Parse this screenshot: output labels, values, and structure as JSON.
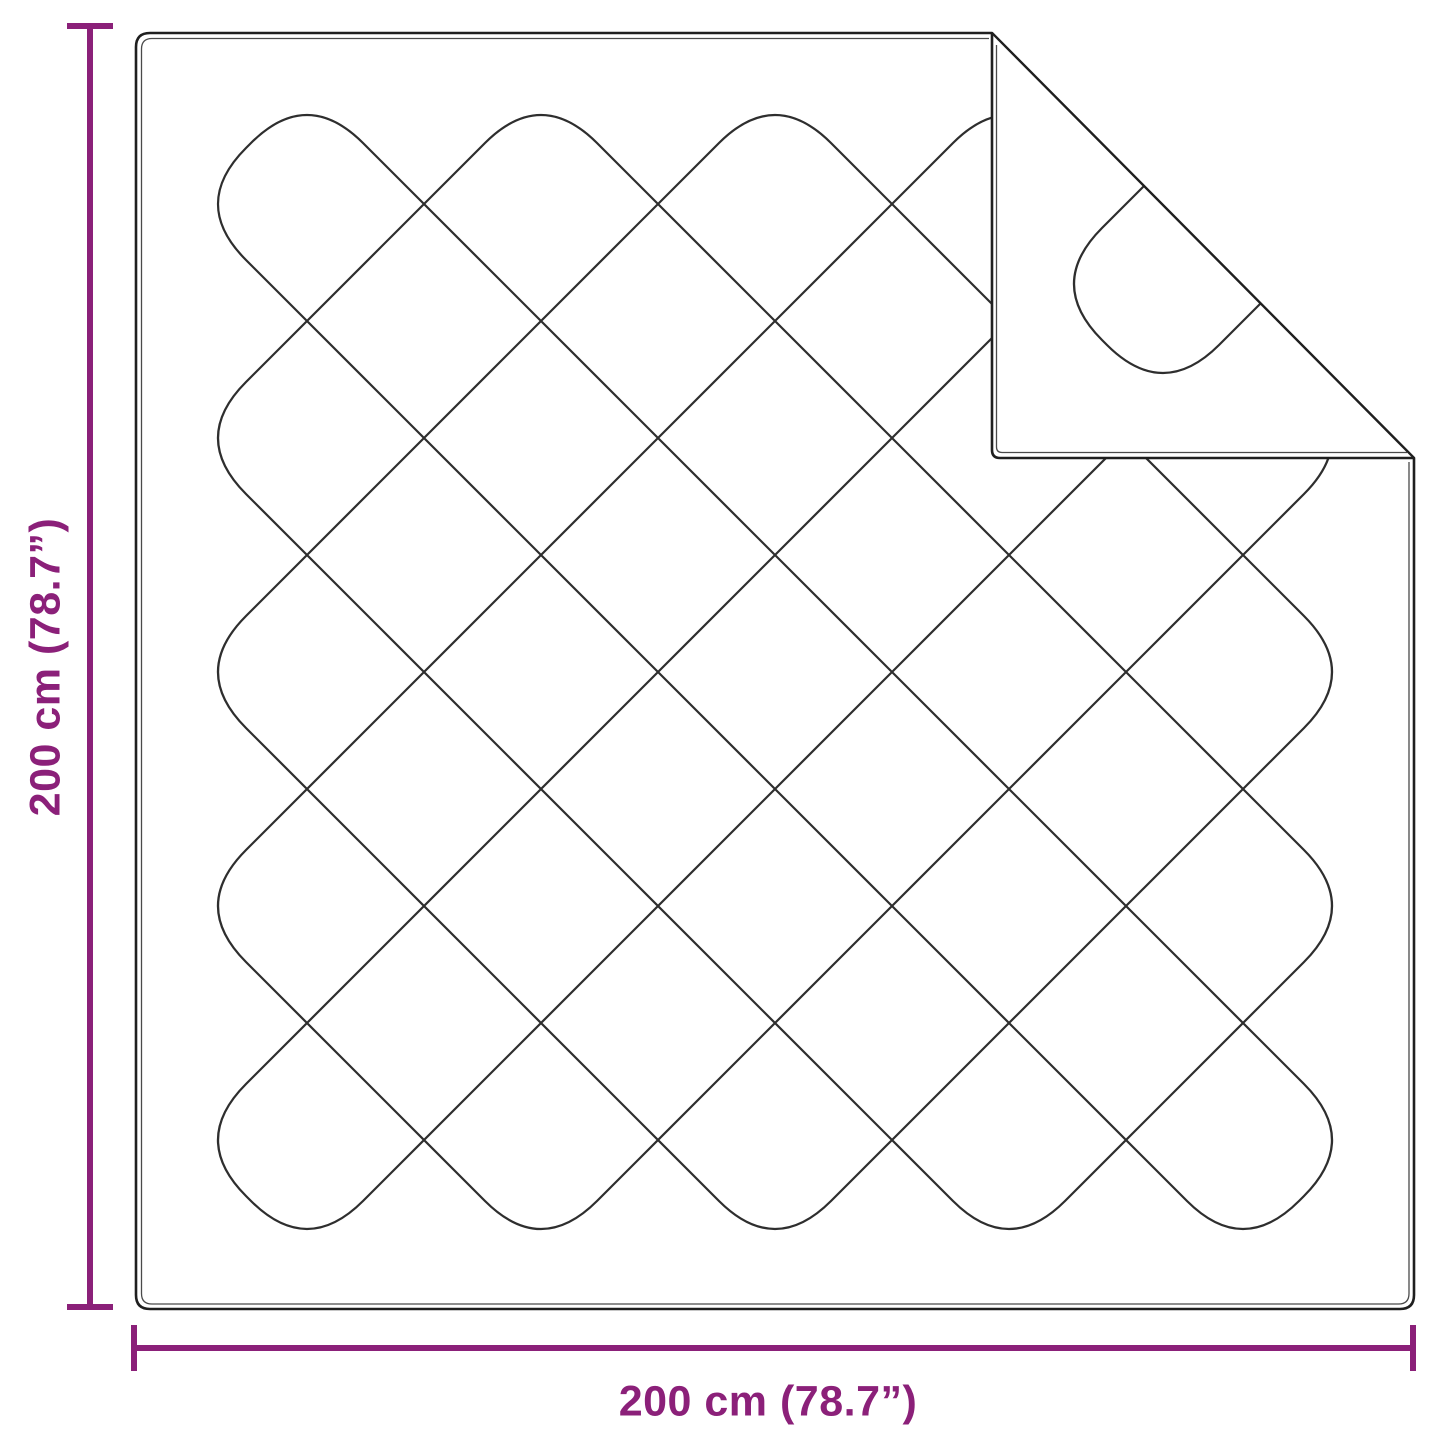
{
  "figure": {
    "kind": "quilted-blanket-dimension-diagram"
  },
  "dimensions": {
    "height": {
      "label": "200 cm (78.7”)"
    },
    "width": {
      "label": "200 cm (78.7”)"
    }
  },
  "colors": {
    "accent": "#8b2079",
    "outline": "#1f1f1f",
    "echo": "#4a4a4a",
    "stitch": "#2e2e2e",
    "background": "#ffffff"
  }
}
